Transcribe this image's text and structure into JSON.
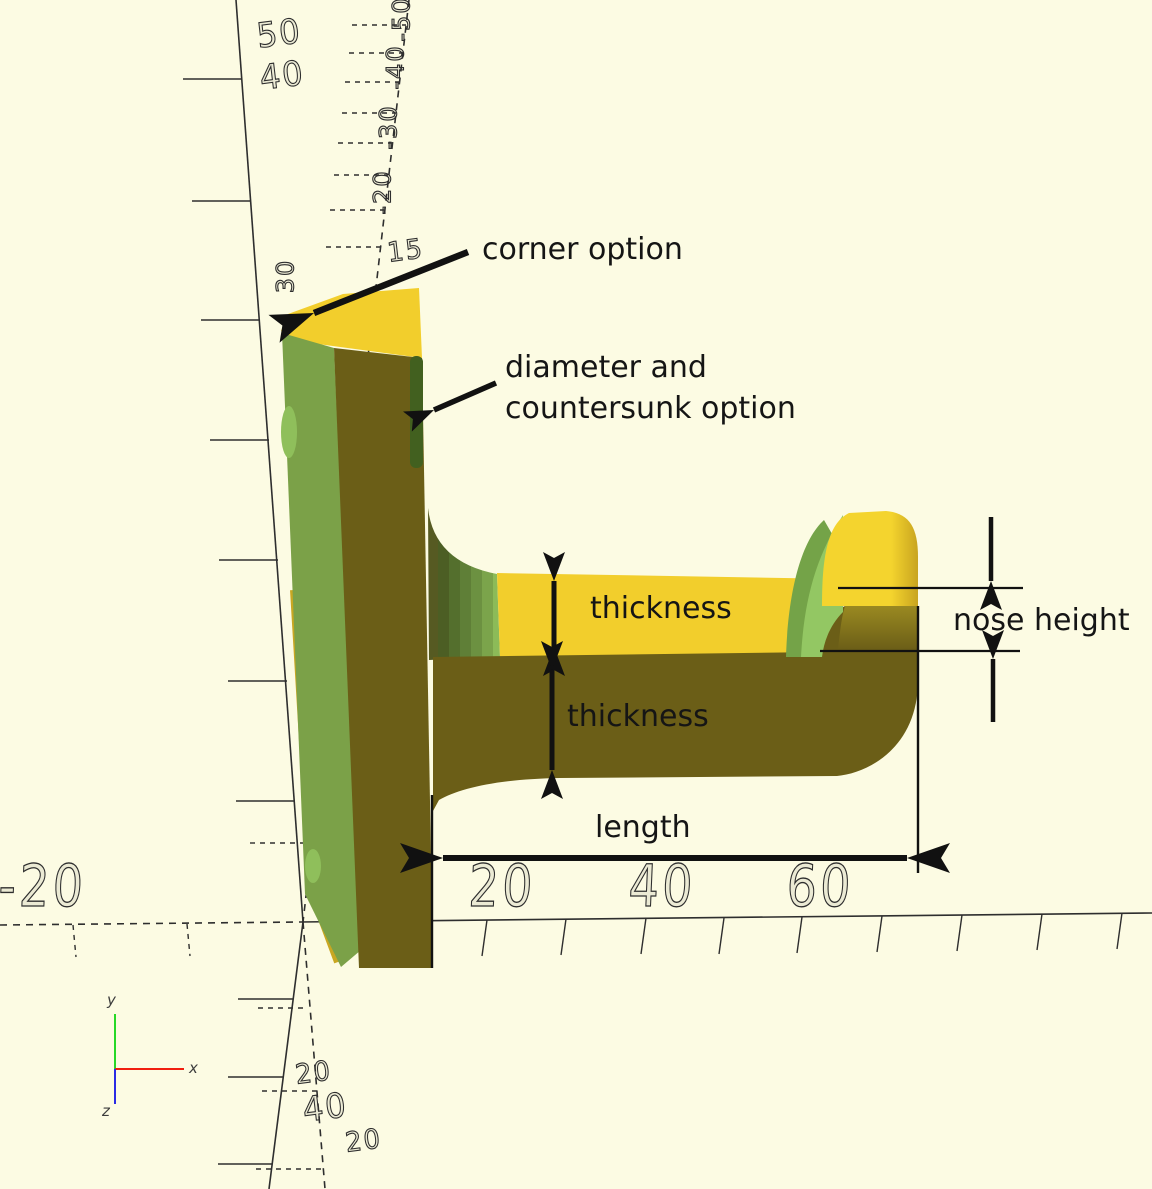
{
  "scene": {
    "description": "OpenSCAD-style 3D viewport showing a yellow hook bracket with dimension annotations"
  },
  "palette": {
    "bg": "#FCFBE3",
    "axis": "#2e2e2e",
    "top_yellow": "#F2CE2C",
    "side_green": "#7BA148",
    "front_olive": "#6B5E17",
    "sliver_yellow": "#C9A722",
    "hole_green": "#42601F",
    "nose_green_light": "#93C763",
    "nose_green_mid": "#74A348",
    "knob_yellow": "#F4D42E",
    "knob_shade": "#C8A41F",
    "shoulder_olive": "#9A8921",
    "bump_green": "#8FBF5B",
    "gizmo_x": "#F01E0F",
    "gizmo_y": "#27D827",
    "gizmo_z": "#2B2BE4",
    "annotation": "#151515"
  },
  "annotations": {
    "corner_option": "corner option",
    "countersunk": "diameter and\ncountersunk option",
    "thickness_top": "thickness",
    "thickness_bottom": "thickness",
    "nose_height": "nose height",
    "length": "length"
  },
  "axes": {
    "x_labels": [
      "-20",
      "20",
      "40",
      "60"
    ],
    "y_wire_labels": [
      "50",
      "40",
      "30"
    ],
    "z_wire_labels": [
      "-50",
      "-40",
      "-30",
      "-20",
      "15"
    ],
    "origin_wire_labels": [
      "20",
      "40",
      "20"
    ],
    "gizmo": {
      "x_label": "x",
      "y_label": "y",
      "z_label": "z"
    }
  }
}
